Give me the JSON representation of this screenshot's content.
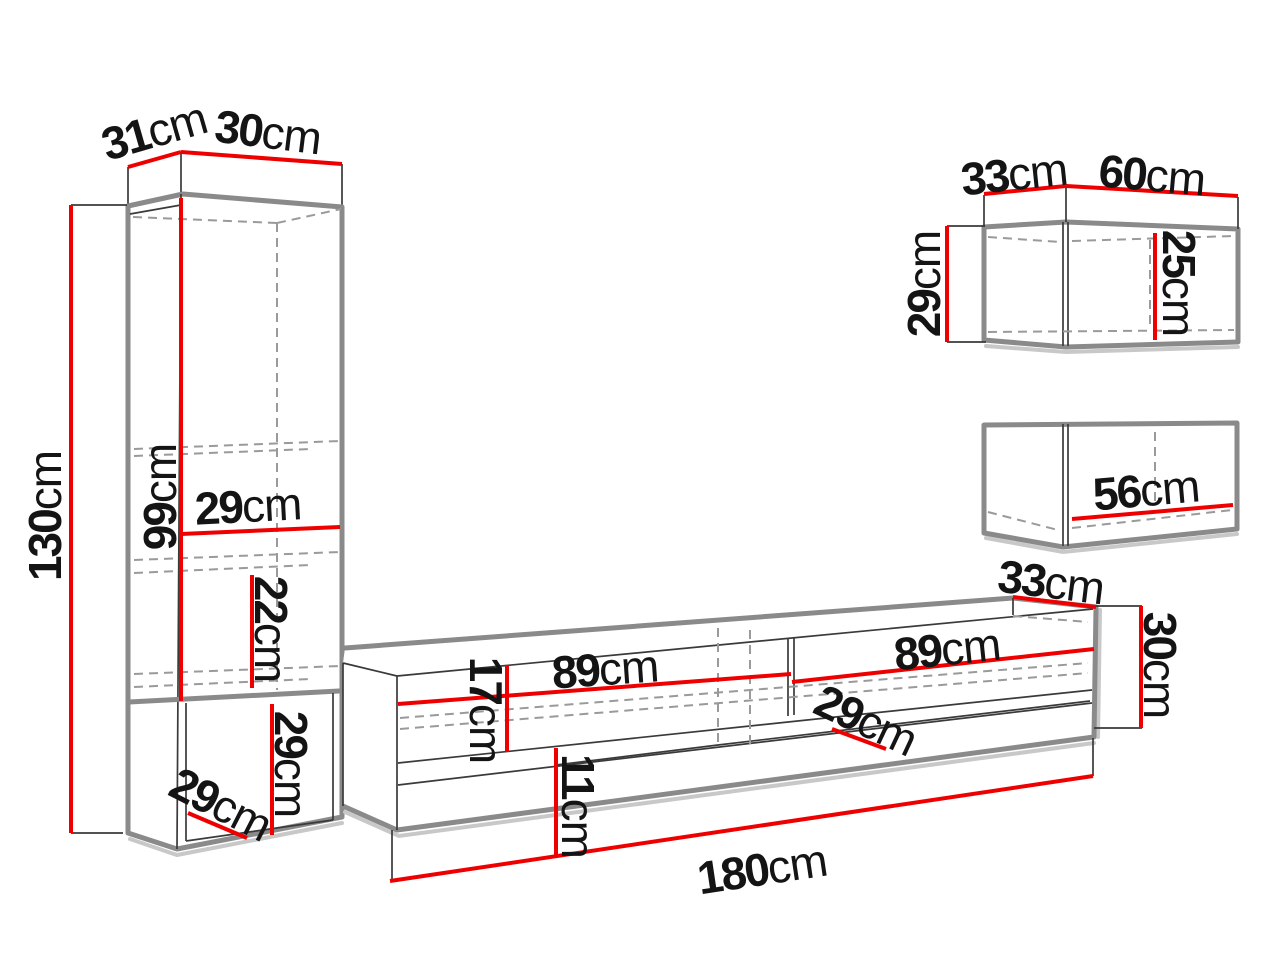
{
  "diagram": {
    "title": "Wall unit furniture dimension diagram",
    "unit": "cm",
    "pieces": [
      {
        "id": "tall-cabinet",
        "name": "Tall display cabinet",
        "dimensions_cm": {
          "top_depth": 31,
          "top_width": 30,
          "total_height": 130,
          "interior_height": 99,
          "shelf_width": 29,
          "shelf_spacing": 22,
          "open_compartment_height": 29,
          "open_compartment_depth": 29
        }
      },
      {
        "id": "tv-stand",
        "name": "TV stand",
        "dimensions_cm": {
          "total_width": 180,
          "left_compartment_width": 89,
          "right_compartment_width": 89,
          "compartment_height": 17,
          "bottom_gap_height": 11,
          "end_depth": 33,
          "end_height": 30,
          "interior_depth": 29
        }
      },
      {
        "id": "wall-cabinet",
        "name": "Wall cabinet",
        "dimensions_cm": {
          "top_depth": 33,
          "top_width": 60,
          "height": 29,
          "interior_height": 25
        }
      },
      {
        "id": "wall-shelf-cabinet",
        "name": "Wall shelf cabinet",
        "dimensions_cm": {
          "interior_width": 56
        }
      }
    ]
  },
  "labels": {
    "tc_top_depth": {
      "value": "31",
      "unit": "cm"
    },
    "tc_top_width": {
      "value": "30",
      "unit": "cm"
    },
    "tc_height": {
      "value": "130",
      "unit": "cm"
    },
    "tc_inner_height": {
      "value": "99",
      "unit": "cm"
    },
    "tc_shelf_width": {
      "value": "29",
      "unit": "cm"
    },
    "tc_shelf_spacing": {
      "value": "22",
      "unit": "cm"
    },
    "tc_lower_height": {
      "value": "29",
      "unit": "cm"
    },
    "tc_lower_depth": {
      "value": "29",
      "unit": "cm"
    },
    "tv_left_width": {
      "value": "89",
      "unit": "cm"
    },
    "tv_right_width": {
      "value": "89",
      "unit": "cm"
    },
    "tv_shelf_height": {
      "value": "17",
      "unit": "cm"
    },
    "tv_bottom_gap": {
      "value": "11",
      "unit": "cm"
    },
    "tv_end_depth": {
      "value": "33",
      "unit": "cm"
    },
    "tv_end_height": {
      "value": "30",
      "unit": "cm"
    },
    "tv_inner_depth": {
      "value": "29",
      "unit": "cm"
    },
    "tv_total_width": {
      "value": "180",
      "unit": "cm"
    },
    "wc_top_depth": {
      "value": "33",
      "unit": "cm"
    },
    "wc_top_width": {
      "value": "60",
      "unit": "cm"
    },
    "wc_height": {
      "value": "29",
      "unit": "cm"
    },
    "wc_inner_height": {
      "value": "25",
      "unit": "cm"
    },
    "ws_inner_width": {
      "value": "56",
      "unit": "cm"
    }
  },
  "colors": {
    "dimension_red": "#ee0000",
    "outline_gray": "#8a8a8a",
    "line_dark": "#3a3a3a",
    "dashed_gray": "#9a9a9a",
    "shadow_gray": "#c8c8c8",
    "background": "#ffffff",
    "label_black": "#141414"
  }
}
